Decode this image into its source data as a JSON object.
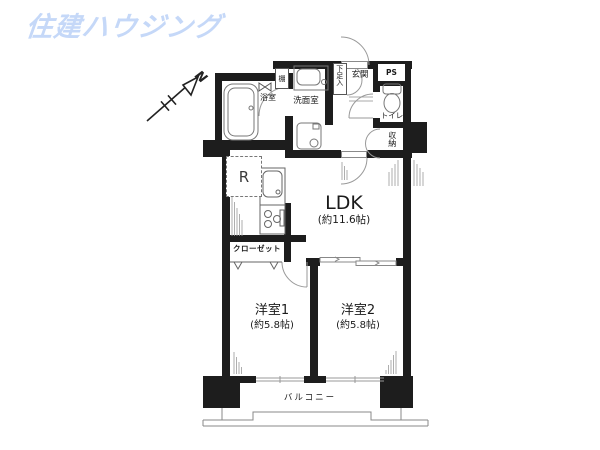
{
  "logo": {
    "text": "住建ハウジング",
    "color": "#c5d8f8"
  },
  "compass": {
    "north_label": "N"
  },
  "floor_plan": {
    "wall_color": "#1d1d1d",
    "fixture_line_color": "#8a8a8a",
    "labels": {
      "ldk": "LDK",
      "ldk_size": "(約11.6帖)",
      "bedroom1": "洋室1",
      "bedroom1_size": "(約5.8帖)",
      "bedroom2": "洋室2",
      "bedroom2_size": "(約5.8帖)",
      "balcony": "バルコニー",
      "closet": "クローゼット",
      "bathroom": "浴室",
      "washroom": "洗面室",
      "entrance": "玄関",
      "shoe_cabinet": "下足入",
      "toilet": "トイレ",
      "storage": "収納",
      "pipe_space": "PS",
      "shelf": "棚",
      "refrigerator": "R"
    }
  }
}
